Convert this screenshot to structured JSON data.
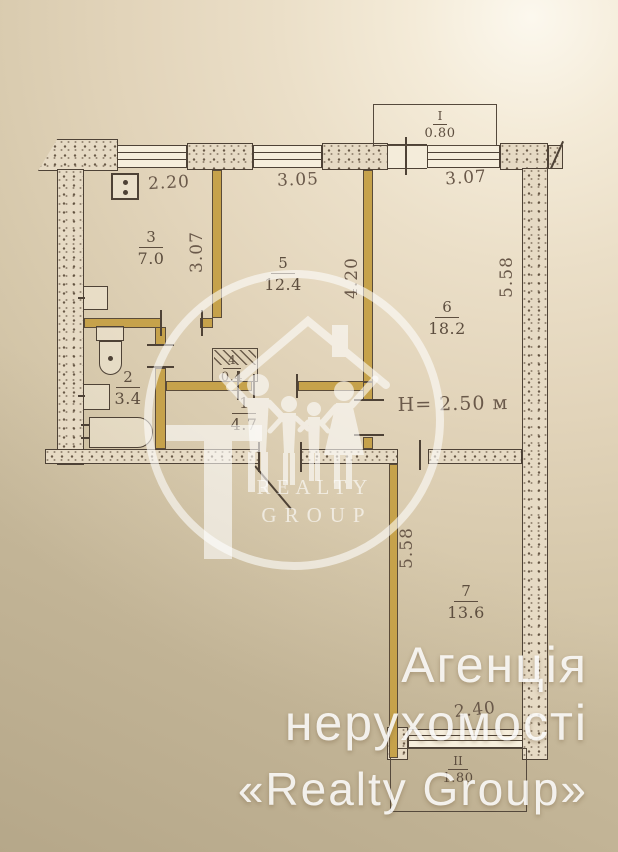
{
  "plan": {
    "rooms": [
      {
        "num": "3",
        "area": "7.0"
      },
      {
        "num": "5",
        "area": "12.4"
      },
      {
        "num": "6",
        "area": "18.2"
      },
      {
        "num": "2",
        "area": "3.4"
      },
      {
        "num": "4",
        "area": "0.4"
      },
      {
        "num": "1",
        "area": "4.7"
      },
      {
        "num": "7",
        "area": "13.6"
      }
    ],
    "balconies": [
      {
        "num": "I",
        "dim": "0.80"
      },
      {
        "num": "II",
        "dim": "1.80"
      }
    ],
    "dims": {
      "top_kitchen": "2.20",
      "top_room5": "3.05",
      "top_room6": "3.07",
      "kitchen_depth": "3.07",
      "room5_depth": "4.20",
      "room6_depth": "5.58",
      "room7_depth": "5.58",
      "bottom_window": "2.40",
      "ceiling_height": "H= 2.50 м"
    },
    "colors": {
      "ink": "#4e4236",
      "interior_wall": "#c6a24b",
      "paper": "#ebdfc8"
    }
  },
  "watermark": {
    "line1": "REALTY",
    "line2": "GROUP"
  },
  "agency": {
    "line1": "Агенція",
    "line2": "нерухомості",
    "line3": "«Realty Group»"
  }
}
